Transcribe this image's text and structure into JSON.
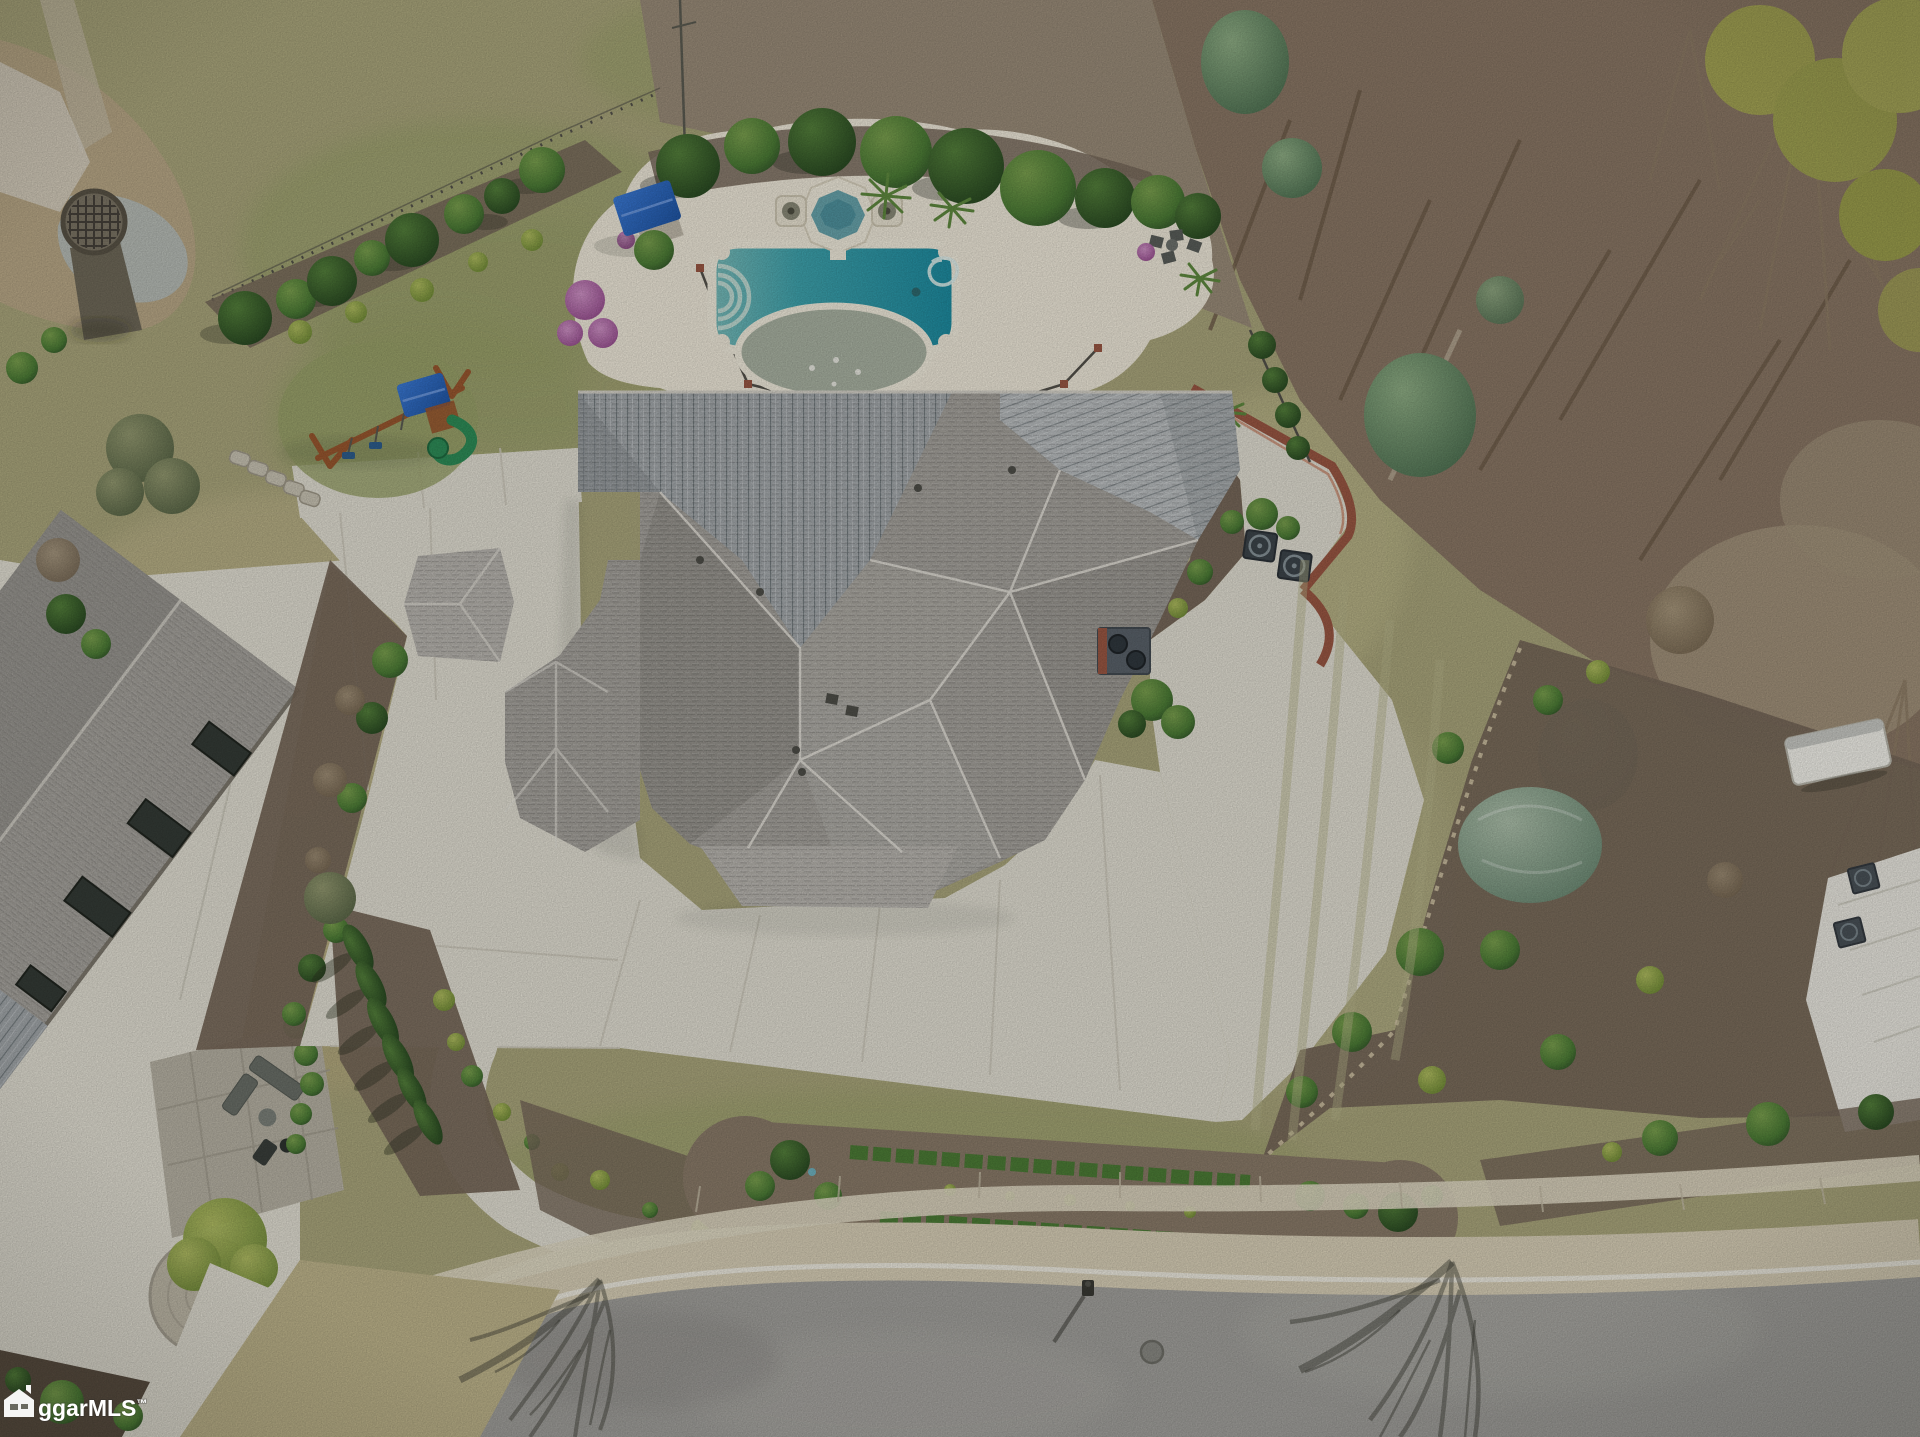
{
  "watermark": {
    "icon": "mls-house-logo-icon",
    "text": "ggarMLS",
    "trademark": "™"
  },
  "palette": {
    "lawn": "#aaa67c",
    "lawnGreen": "#98a169",
    "lawnPale": "#bfb58c",
    "forest": "#8a7765",
    "forestDark": "#6e5c49",
    "leafLitter": "#a3947c",
    "pebble": "#9a8c79",
    "mulch": "#77685a",
    "mulchDark": "#5a4e41",
    "gardenMulch": "#8a7b69",
    "concrete": "#e2dfd3",
    "deck": "#efe9da",
    "concreteShade": "#d2cfc1",
    "road": "#a2a19d",
    "curb": "#d8cfb7",
    "shingle": "#a3a09a",
    "shingleLight": "#b6b3ad",
    "shingleDark": "#8a8782",
    "metal": "#a2a7aa",
    "metalLight": "#b7bbbd",
    "metalDark": "#8a9093",
    "ridge": "#e7e4dc",
    "fence": "#53514a",
    "waterDeep": "#1d8ba0",
    "waterMid": "#3fa3ad",
    "waterLight": "#79bcba",
    "poolLedge": "#a9b2a2",
    "spaWater": "#68a4ac",
    "coping": "#f1ecdd",
    "hedge": "#4c7c36",
    "hedgeDark": "#355e29",
    "limeGreen": "#97a84e",
    "oliveGreen": "#7e8a5c",
    "cedarGreen": "#6f9468",
    "juniperBlue": "#8ba690",
    "azaleaPink": "#b470ac",
    "canopyBlue": "#2e6dc6",
    "playWood": "#99572f",
    "slideGreen": "#2e8d58",
    "brick": "#9a5743",
    "white": "#f3f1e8",
    "whiteRoof": "#eae8e0",
    "shadow": "rgba(45,48,38,0.35)"
  }
}
